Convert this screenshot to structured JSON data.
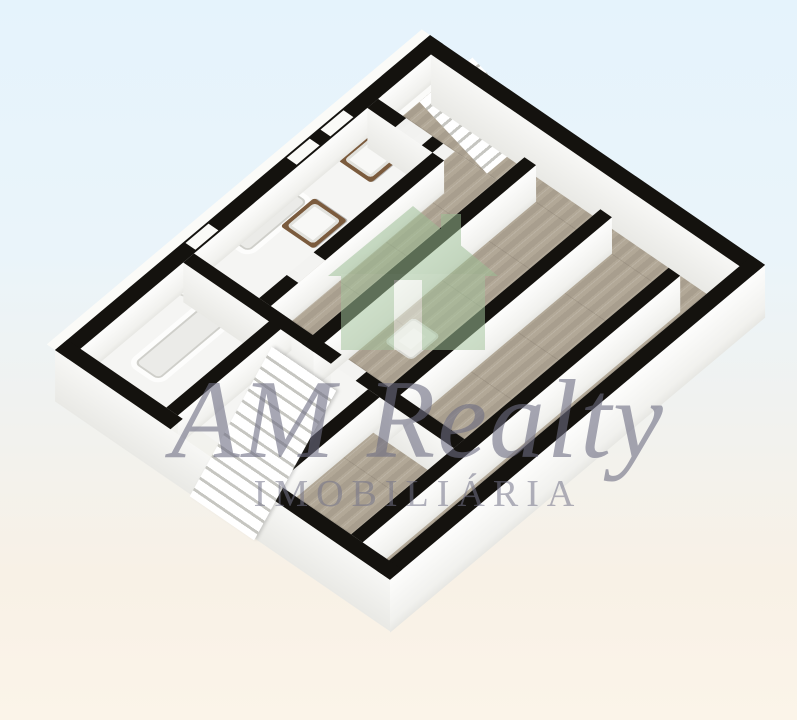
{
  "image": {
    "kind": "3d-floorplan-render",
    "view": "isometric top-down, plan rotated ~40 degrees"
  },
  "watermark": {
    "brand": "AM Realty",
    "subtitle": "IMOBILIÁRIA",
    "logo": "house-logo",
    "logo_color": "#9cbf95",
    "text_color": "#6c6c82"
  },
  "palette": {
    "background_top": "#e5f3fc",
    "background_bottom": "#fbf4e9",
    "wall_caps": "#14120e",
    "wall_faces": "#f7f7f5",
    "wood_floor": "#b2a897",
    "bathroom_floor": "#f3f3f1",
    "vanity_cabinet": "#7b5b3d",
    "fixture_white": "#fdfdfc"
  },
  "floorplan": {
    "rooms": [
      "bathroom-left",
      "bathroom-top",
      "stair-room-upper-right",
      "hallway",
      "bedroom-right-1",
      "bedroom-right-2",
      "bedroom-bottom",
      "room-lower-left",
      "stair-hall-left"
    ],
    "fixtures": [
      "bathtub-left",
      "toilet-left",
      "bathtub-top",
      "vanity-sink-left",
      "vanity-sink-right",
      "shower-tray"
    ],
    "stairs": [
      "staircase-upper-right",
      "staircase-lower-left"
    ],
    "openings": [
      "window-top-1",
      "window-top-2",
      "window-top-3",
      "door-gaps-interior"
    ]
  }
}
